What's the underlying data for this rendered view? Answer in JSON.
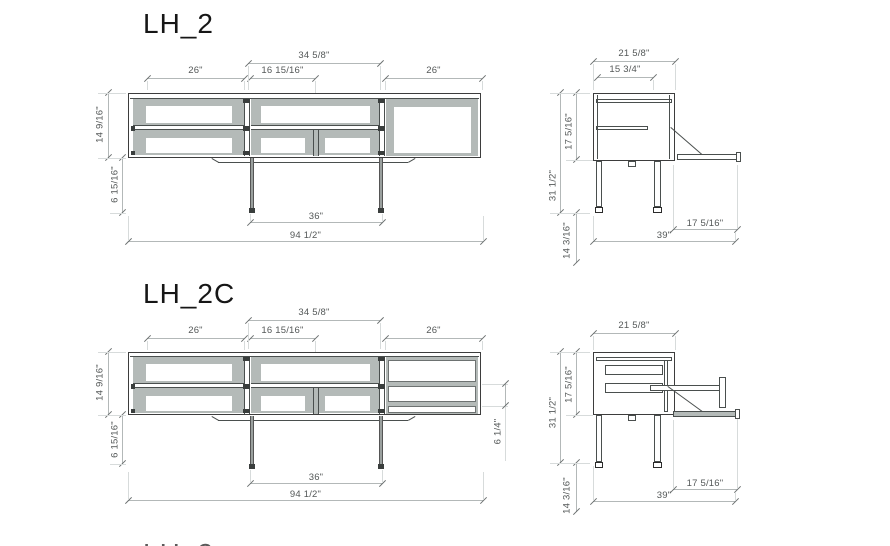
{
  "style": {
    "panel_gray": "#b4bab8",
    "line_dark": "#3d3d3d",
    "dim_text": "#545858"
  },
  "s0": {
    "title": "LH_2",
    "front": {
      "w_mid_total": "34 5/8\"",
      "w_left": "26\"",
      "w_mid_open": "16 15/16\"",
      "w_right": "26\"",
      "h_body": "14 9/16\"",
      "h_leg": "6 15/16\"",
      "w_leg_span": "36\"",
      "w_total": "94 1/2\""
    },
    "side": {
      "d_top": "21 5/8\"",
      "d_inner": "15 3/4\"",
      "h_total": "31 1/2\"",
      "h_body": "17 5/16\"",
      "h_below": "14 3/16\"",
      "d_flap": "17 5/16\"",
      "d_total": "39\""
    }
  },
  "s1": {
    "title": "LH_2C",
    "front": {
      "w_mid_total": "34 5/8\"",
      "w_left": "26\"",
      "w_mid_open": "16 15/16\"",
      "w_right": "26\"",
      "h_body": "14 9/16\"",
      "h_leg": "6 15/16\"",
      "h_drawer": "6 1/4\"",
      "w_leg_span": "36\"",
      "w_total": "94 1/2\""
    },
    "side": {
      "d_top": "21 5/8\"",
      "h_total": "31 1/2\"",
      "h_body": "17 5/16\"",
      "h_below": "14 3/16\"",
      "d_flap": "17 5/16\"",
      "d_total": "39\""
    }
  },
  "cropped_title": "LH_2"
}
